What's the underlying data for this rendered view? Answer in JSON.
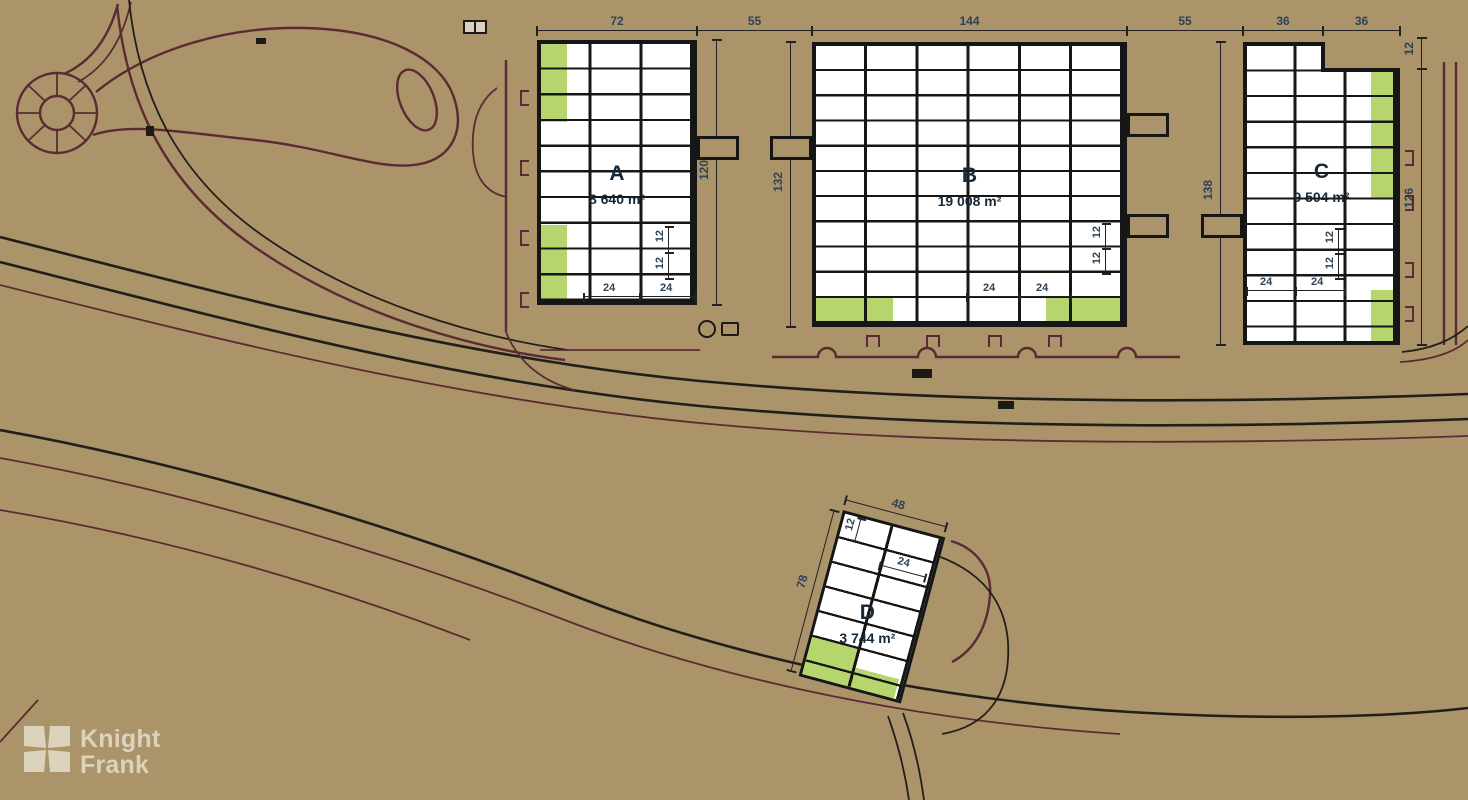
{
  "plan": {
    "buildings": [
      {
        "id": "A",
        "label": "A",
        "area": "8 640 m²"
      },
      {
        "id": "B",
        "label": "B",
        "area": "19 008 m²"
      },
      {
        "id": "C",
        "label": "C",
        "area": "9 504 m²"
      },
      {
        "id": "D",
        "label": "D",
        "area": "3 744 m²"
      }
    ],
    "dims": {
      "top": [
        "72",
        "55",
        "144",
        "55",
        "36",
        "36"
      ],
      "a_depth": "120",
      "b_depth": "132",
      "c_depth_left": "138",
      "c_depth_right": "126",
      "c_notch": "12",
      "d_width": "48",
      "d_depth": "78",
      "bay_width": "12",
      "bay_depth": "24"
    },
    "colors": {
      "background": "#ab9469",
      "available_unit": "#b6d56d",
      "building_fill": "#ffffff",
      "outline": "#161616",
      "road": "#5b2a33"
    }
  },
  "branding": {
    "line1": "Knight",
    "line2": "Frank",
    "color": "#dcd3bd"
  }
}
